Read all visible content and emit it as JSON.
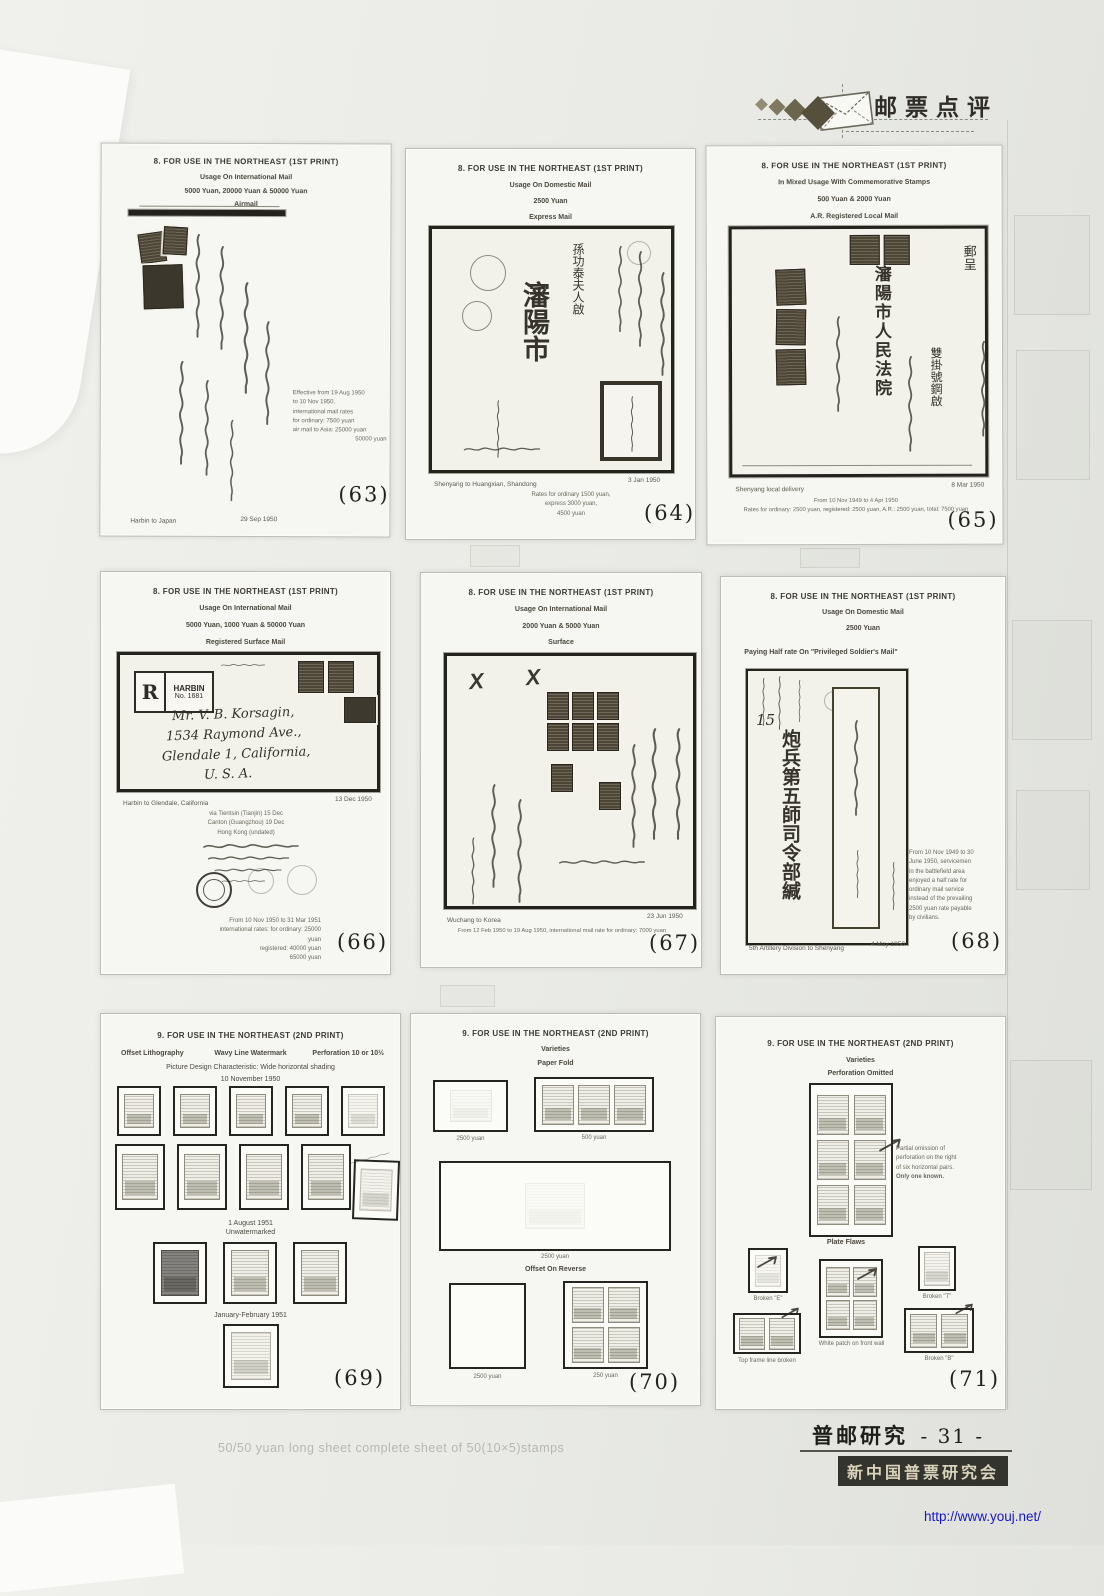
{
  "scan": {
    "masthead": {
      "title": "邮票点评"
    },
    "footer": {
      "journal": "普邮研究",
      "page_no": "- 31 -",
      "society": "新中国普票研究会",
      "url": "http://www.youj.net/"
    },
    "ghost_text": "50/50 yuan long sheet  complete sheet of 50(10×5)stamps"
  },
  "pages": [
    {
      "number": "(63)",
      "h1": "8.  FOR USE IN THE NORTHEAST (1ST PRINT)",
      "h2": "Usage On International Mail",
      "h3": "5000 Yuan, 20000 Yuan & 50000 Yuan",
      "h4": "Airmail",
      "note_lines": [
        "Effective from 19 Aug 1950",
        "to 10 Nov 1950,",
        "international mail rates",
        "for ordinary:  7500 yuan",
        "air mail to Asia:  25000 yuan",
        "50000 yuan"
      ],
      "caption_left": "Harbin to Japan",
      "caption_right": "29 Sep 1950"
    },
    {
      "number": "(64)",
      "h1": "8.  FOR USE IN THE NORTHEAST (1ST PRINT)",
      "h2": "Usage On Domestic Mail",
      "h3": "2500 Yuan",
      "h4": "Express Mail",
      "chars_city": "瀋陽市",
      "chars_addressee": "孫功泰夫人啟",
      "note_lines": [
        "Rates for ordinary 1500 yuan,",
        "express 3000 yuan,",
        "4500 yuan"
      ],
      "caption_left": "Shenyang to Huangxian, Shandong",
      "caption_right": "3 Jan 1950"
    },
    {
      "number": "(65)",
      "h1": "8.  FOR USE IN THE NORTHEAST (1ST PRINT)",
      "h2": "In Mixed Usage With Commemorative Stamps",
      "h3": "500 Yuan & 2000 Yuan",
      "h4": "A.R. Registered Local Mail",
      "chars_main": "瀋陽市人民法院",
      "chars_right": "郵呈",
      "chars_reg": "雙掛號鋼啟",
      "caption_left": "Shenyang local delivery",
      "caption_right": "8 Mar 1950",
      "note_lines": [
        "From 10 Nov 1949 to 4 Apr 1950",
        "Rates for ordinary: 2500 yuan, registered: 2500 yuan, A.R.: 2500 yuan,  total: 7500 yuan"
      ]
    },
    {
      "number": "(66)",
      "h1": "8.  FOR USE IN THE NORTHEAST (1ST PRINT)",
      "h2": "Usage On International Mail",
      "h3": "5000 Yuan, 1000 Yuan & 50000 Yuan",
      "h4": "Registered Surface Mail",
      "reg_r": "R",
      "reg_city": "HARBIN",
      "reg_no": "No. 1681",
      "address_lines": [
        "Mr. V. B. Korsagin,",
        "1534 Raymond Ave.,",
        "Glendale 1, California,",
        "U. S. A."
      ],
      "caption_left": "Harbin to Glendale, California",
      "caption_right": "13 Dec 1950",
      "route_lines": [
        "via Tientsin (Tianjin) 15 Dec",
        "Canton (Guangzhou) 19 Dec",
        "Hong Kong (undated)"
      ],
      "note_lines": [
        "From 10 Nov 1950 to 31 Mar 1951",
        "international rates: for ordinary:  25000 yuan",
        "registered:  40000 yuan",
        "65000 yuan"
      ]
    },
    {
      "number": "(67)",
      "h1": "8.  FOR USE IN THE NORTHEAST (1ST PRINT)",
      "h2": "Usage On International Mail",
      "h3": "2000 Yuan & 5000 Yuan",
      "h4": "Surface",
      "cover_marks": "X X",
      "caption_left": "Wuchang to Korea",
      "caption_right": "23 Jun 1950",
      "note": "From 12 Feb 1950 to 19 Aug 1950, international mail rate for ordinary: 7000 yuan"
    },
    {
      "number": "(68)",
      "h1": "8.  FOR USE IN THE NORTHEAST (1ST PRINT)",
      "h2": "Usage On Domestic Mail",
      "h3": "2500 Yuan",
      "h4": "Paying Half rate On \"Privileged Soldier's Mail\"",
      "manuscript": "15",
      "envelope_chars": "炮兵第五師司令部緘",
      "note_lines": [
        "From 10 Nov 1949 to 30",
        "June 1950, servicemen",
        "in the battlefield area",
        "enjoyed a half rate for",
        "ordinary mail service",
        "instead of the prevailing",
        "2500 yuan rate payable",
        "by civilians."
      ],
      "caption_left": "5th Artillery Division to Shenyang",
      "caption_right": "4 May 1950"
    },
    {
      "number": "(69)",
      "h1": "9.  FOR USE IN THE NORTHEAST (2ND PRINT)",
      "spec_left": "Offset Lithography",
      "spec_mid": "Wavy Line Watermark",
      "spec_right": "Perforation 10 or 10½",
      "spec_line2": "Picture Design Characteristic: Wide horizontal shading",
      "date1": "10 November 1950",
      "date2a": "1 August 1951",
      "date2b": "Unwatermarked",
      "date3": "January-February 1951"
    },
    {
      "number": "(70)",
      "h1": "9.  FOR USE IN THE NORTHEAST (2ND PRINT)",
      "h2": "Varieties",
      "h3": "Paper Fold",
      "label_box1": "2500 yuan",
      "label_box2": "500 yuan",
      "label_box3": "2500 yuan",
      "section2": "Offset On Reverse",
      "label_box4": "2500 yuan",
      "label_box5": "250 yuan"
    },
    {
      "number": "(71)",
      "h1": "9.  FOR USE IN THE NORTHEAST (2ND PRINT)",
      "h2": "Varieties",
      "h3": "Perforation Omitted",
      "note_lines": [
        "Partial omission of",
        "perforation on the right",
        "of six horizontal pairs.",
        "Only one known."
      ],
      "section2": "Plate Flaws",
      "flaw1": "Broken \"E\"",
      "flaw2": "Broken \"T\"",
      "flaw3": "White patch on front wall",
      "flaw4": "Top frame line broken",
      "flaw5": "Broken \"B\""
    }
  ]
}
